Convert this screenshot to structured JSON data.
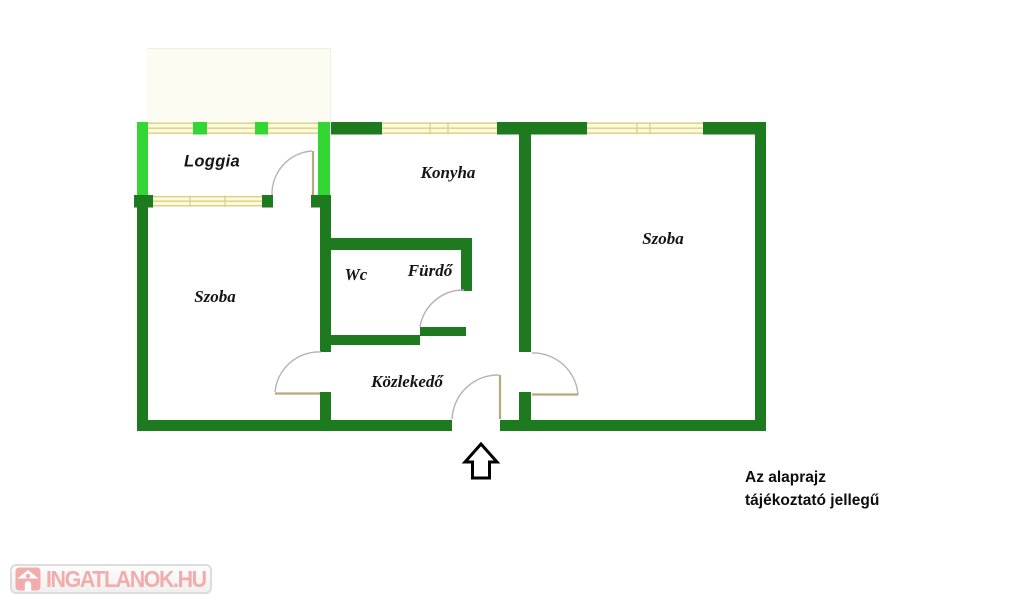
{
  "floorplan": {
    "rooms": [
      {
        "name": "loggia",
        "label": "Loggia"
      },
      {
        "name": "konyha",
        "label": "Konyha"
      },
      {
        "name": "szoba-right",
        "label": "Szoba"
      },
      {
        "name": "szoba-left",
        "label": "Szoba"
      },
      {
        "name": "wc",
        "label": "Wc"
      },
      {
        "name": "furdo",
        "label": "Fürdő"
      },
      {
        "name": "kozlekedo",
        "label": "Közlekedő"
      }
    ],
    "disclaimer": {
      "line1": "Az alaprajz",
      "line2": "tájékoztató jellegű"
    },
    "entrance_arrow": "up-arrow-icon",
    "colors": {
      "wall": "#1e7a1e",
      "loggia_wall": "#33d633",
      "window_fill": "#fdfbda",
      "window_line": "#d8d08c",
      "door_arc": "#b3b3b3",
      "door_leaf": "#b9a87c",
      "arrow_outline": "#000000"
    }
  },
  "watermark": {
    "text": "INGATLANOK.HU",
    "icon": "house-icon",
    "color": "#f3acac"
  }
}
